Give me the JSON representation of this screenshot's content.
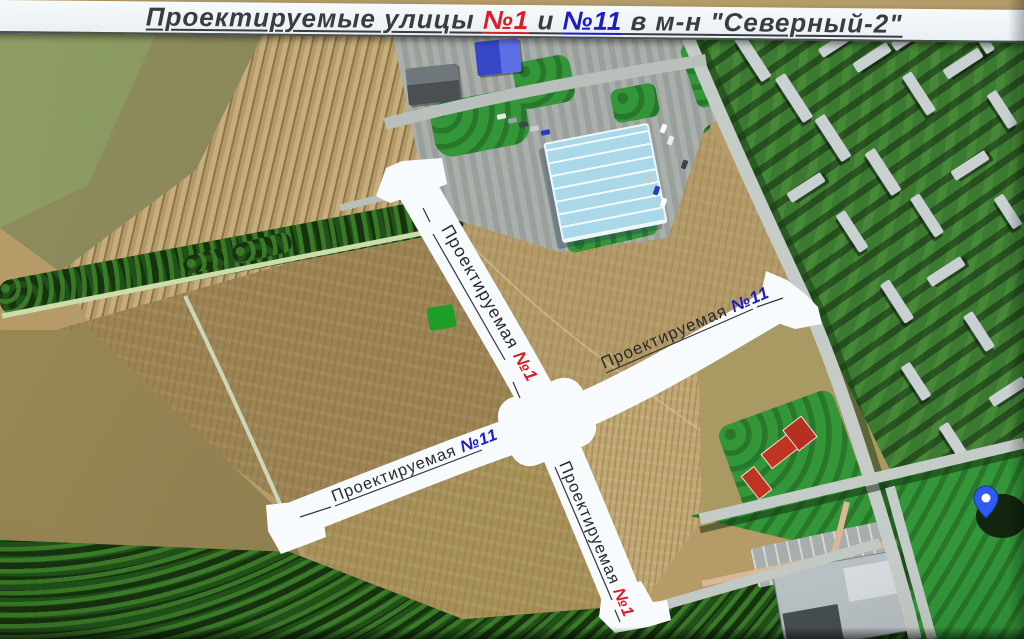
{
  "title": {
    "prefix": "Проектируемые улицы ",
    "num1": "№1",
    "and": " и ",
    "num11": "№11",
    "suffix": " в м-н \"Северный-2\""
  },
  "colors": {
    "num1": "#d81e26",
    "num11": "#1d1dc6",
    "title_text": "#3b3b41",
    "road_fill": "#f7fbfe",
    "pin": "#2e5cf0"
  },
  "road_labels": {
    "road1_top": {
      "name": "Проектируемая ",
      "number": "№1"
    },
    "road11_right": {
      "name": "Проектируемая ",
      "number": "№11"
    },
    "road11_left": {
      "name": "Проектируемая ",
      "number": "№11"
    },
    "road1_bottom": {
      "name": "Проектируемая ",
      "number": "№1"
    }
  },
  "icons": {
    "map_pin": "location-pin"
  }
}
